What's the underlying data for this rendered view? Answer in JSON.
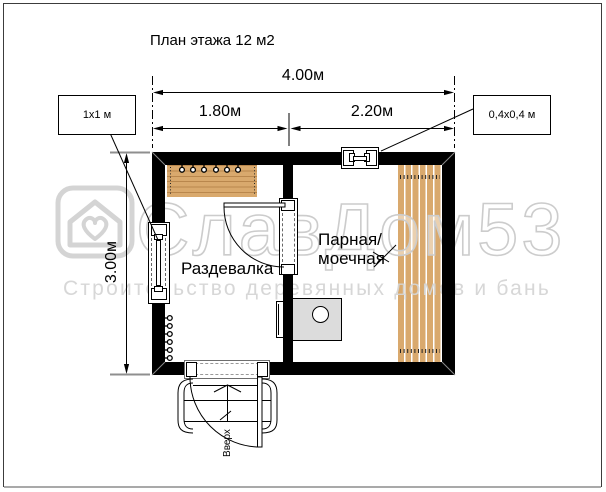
{
  "title": "План этажа 12 м2",
  "dimensions": {
    "total_width": "4.00м",
    "left_width": "1.80м",
    "right_width": "2.20м",
    "height": "3.00м"
  },
  "windows": [
    {
      "label": "1x1 м"
    },
    {
      "label": "0,4x0,4 м"
    }
  ],
  "rooms": [
    {
      "name": "Раздевалка"
    },
    {
      "name": "Парная/моечная",
      "lines": [
        "Парная/",
        "моечная"
      ]
    }
  ],
  "stairs": {
    "direction_label": "Вверх"
  },
  "watermark": {
    "brand": "СлавДом53",
    "tagline": "Строительство деревянных домов и бань"
  },
  "colors": {
    "wall": "#000000",
    "bench_wood": "#d9a96d",
    "bench_plank_line": "#b9874d",
    "stove_fill": "#dcdcdc",
    "watermark_gray": "#cccccc",
    "dimension_extension_gray": "#8f8f8f"
  }
}
